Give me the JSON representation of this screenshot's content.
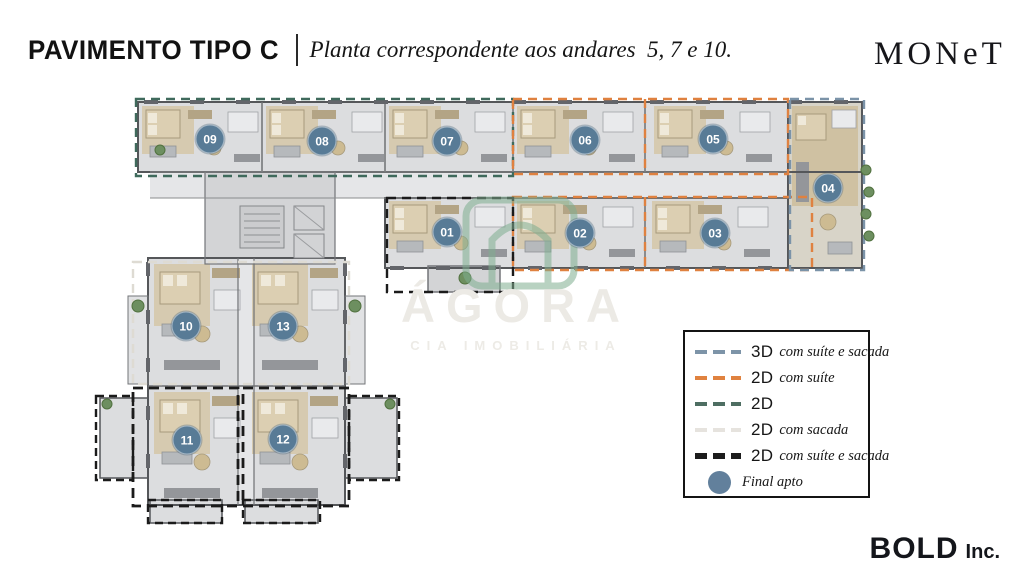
{
  "header": {
    "title": "PAVIMENTO TIPO C",
    "subtitle": "Planta correspondente aos andares  5, 7 e 10.",
    "brand": "MONeT"
  },
  "watermark": {
    "name": "ÁGORA",
    "tagline": "CIA IMOBILIÁRIA"
  },
  "legend": {
    "items": [
      {
        "type": "3D",
        "desc": "com suíte e sacada",
        "color": "#7d94a8",
        "style": "dash",
        "thick": false
      },
      {
        "type": "2D",
        "desc": "com suíte",
        "color": "#e0823f",
        "style": "dash",
        "thick": false
      },
      {
        "type": "2D",
        "desc": "",
        "color": "#4e6e62",
        "style": "dash",
        "thick": false
      },
      {
        "type": "2D",
        "desc": "com sacada",
        "color": "#e6e3de",
        "style": "dash",
        "thick": false
      },
      {
        "type": "2D",
        "desc": "com suíte e sacada",
        "color": "#1c1c1c",
        "style": "dash",
        "thick": true
      },
      {
        "type": "",
        "desc": "Final apto",
        "color": "#62809c",
        "style": "circle",
        "thick": false
      }
    ]
  },
  "floorplan": {
    "badge_color": "#587b96",
    "zone_colors": {
      "suite_sacada_3d": "#7b93a8",
      "suite_2d": "#df8140",
      "plain_2d": "#3f6a5c",
      "sacada_2d": "#dedbd3",
      "suite_sacada_2d": "#1b1b1b"
    },
    "units": [
      {
        "label": "09",
        "x": 210,
        "y": 139
      },
      {
        "label": "08",
        "x": 322,
        "y": 141
      },
      {
        "label": "07",
        "x": 447,
        "y": 141
      },
      {
        "label": "06",
        "x": 585,
        "y": 140
      },
      {
        "label": "05",
        "x": 713,
        "y": 139
      },
      {
        "label": "04",
        "x": 828,
        "y": 188
      },
      {
        "label": "01",
        "x": 447,
        "y": 232
      },
      {
        "label": "02",
        "x": 580,
        "y": 233
      },
      {
        "label": "03",
        "x": 715,
        "y": 233
      },
      {
        "label": "10",
        "x": 186,
        "y": 326
      },
      {
        "label": "13",
        "x": 283,
        "y": 326
      },
      {
        "label": "11",
        "x": 187,
        "y": 440
      },
      {
        "label": "12",
        "x": 283,
        "y": 439
      }
    ]
  },
  "footer": {
    "brand": "BOLD",
    "suffix": "Inc."
  }
}
